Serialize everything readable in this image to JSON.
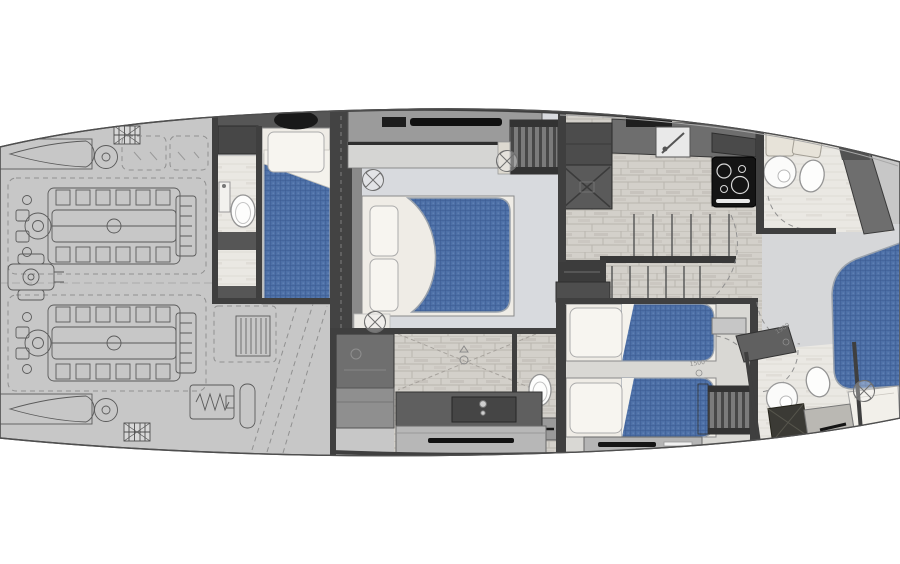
{
  "canvas": {
    "width": 900,
    "height": 564,
    "background": "#ffffff"
  },
  "annotations": {
    "dimension_markers": [
      {
        "text": "1500",
        "location": "twin-guest-cabin-aisle"
      },
      {
        "text": "1900",
        "location": "corridor"
      }
    ]
  },
  "colors": {
    "hull": "#c7c7c7",
    "hull_outline": "#4f4f4f",
    "wall": "#3f3f3f",
    "mattress": "#4d70a7",
    "mattress_grid": "#3b5a90",
    "bedding": "#efece6",
    "master_floor": "#d8dade",
    "wood_floor": "#d3d0ca",
    "wood_line": "#bab6af",
    "bath_floor": "#eae8e3",
    "corridor_floor": "#d6d7d9",
    "counter_dark": "#6e6e6e",
    "appliance_black": "#141414",
    "cabinet_beige": "#e7e3d9",
    "engine_line": "#5a5a5a"
  },
  "semantic_regions": [
    "engine-room",
    "crew-cabin",
    "crew-bathroom",
    "master-cabin",
    "master-bathroom",
    "galley",
    "staircase",
    "twin-guest-cabin",
    "day-head-bathroom",
    "corridor",
    "vip-cabin",
    "vip-bathroom"
  ],
  "icons": {
    "ceiling_fan": "circle-with-cross-blades",
    "vent_grille": "cross-hatched-rectangle",
    "deck_hatch": "black-oval",
    "shower_drain": "circle-with-triangle"
  }
}
